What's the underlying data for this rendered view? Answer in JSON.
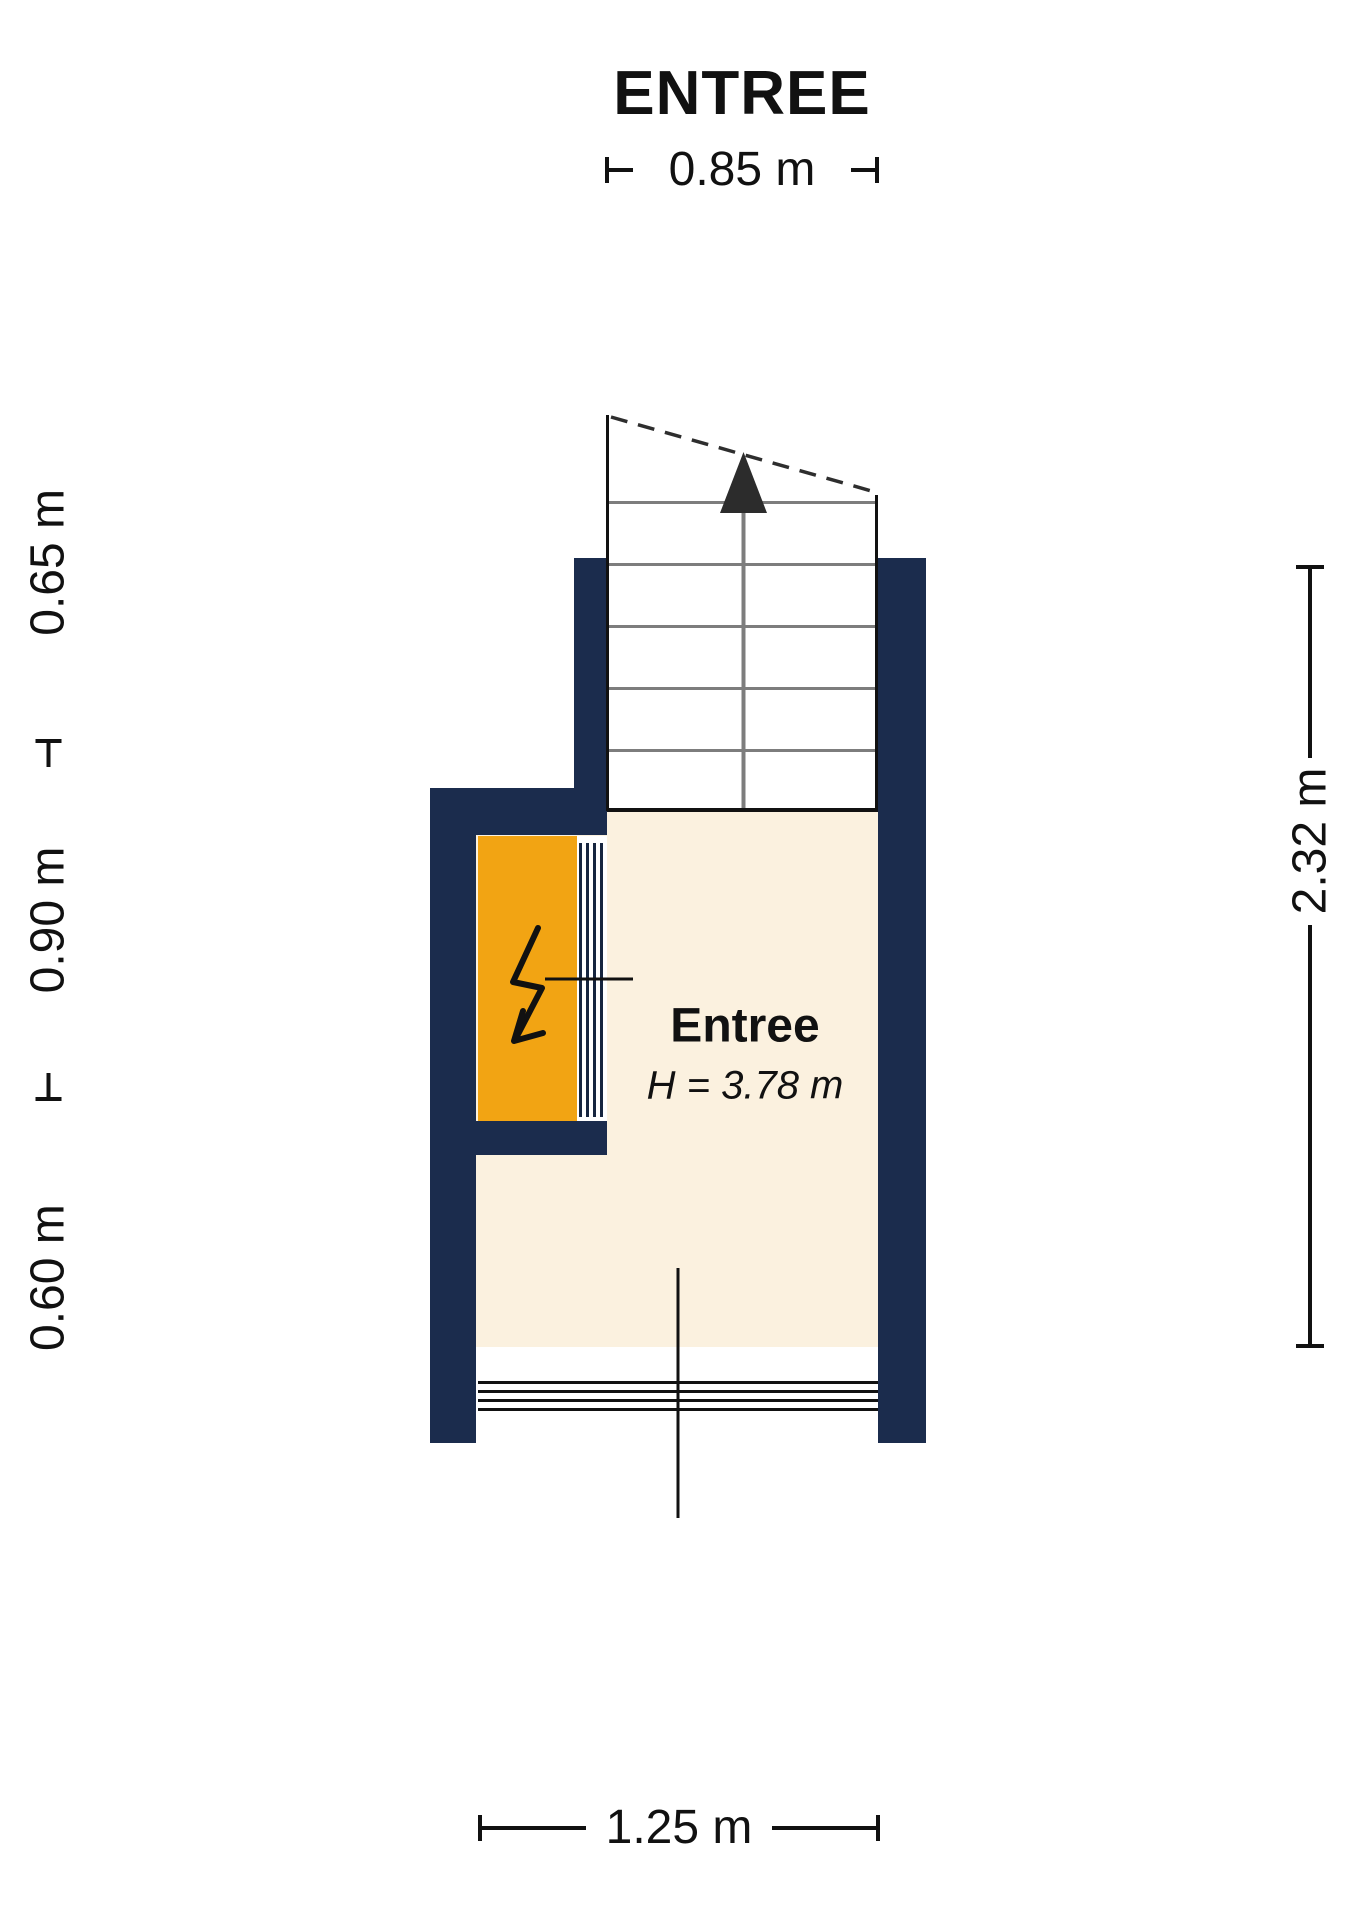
{
  "title": "ENTREE",
  "room": {
    "name": "Entree",
    "height_label": "H = 3.78 m"
  },
  "dimensions": {
    "top": "0.85 m",
    "bottom": "1.25 m",
    "right": "2.32 m",
    "left": {
      "bottom": "0.60 m",
      "middle": "0.90 m",
      "top": "0.65 m"
    }
  },
  "icons": {
    "stairs": "stairs-up-arrow-icon",
    "electric": "lightning-bolt-icon"
  },
  "colors": {
    "wall": "#1B2C4D",
    "floor": "#FBF1DF",
    "closet": "#F2A413",
    "tread": "#7d7d7d",
    "line": "#111111"
  }
}
